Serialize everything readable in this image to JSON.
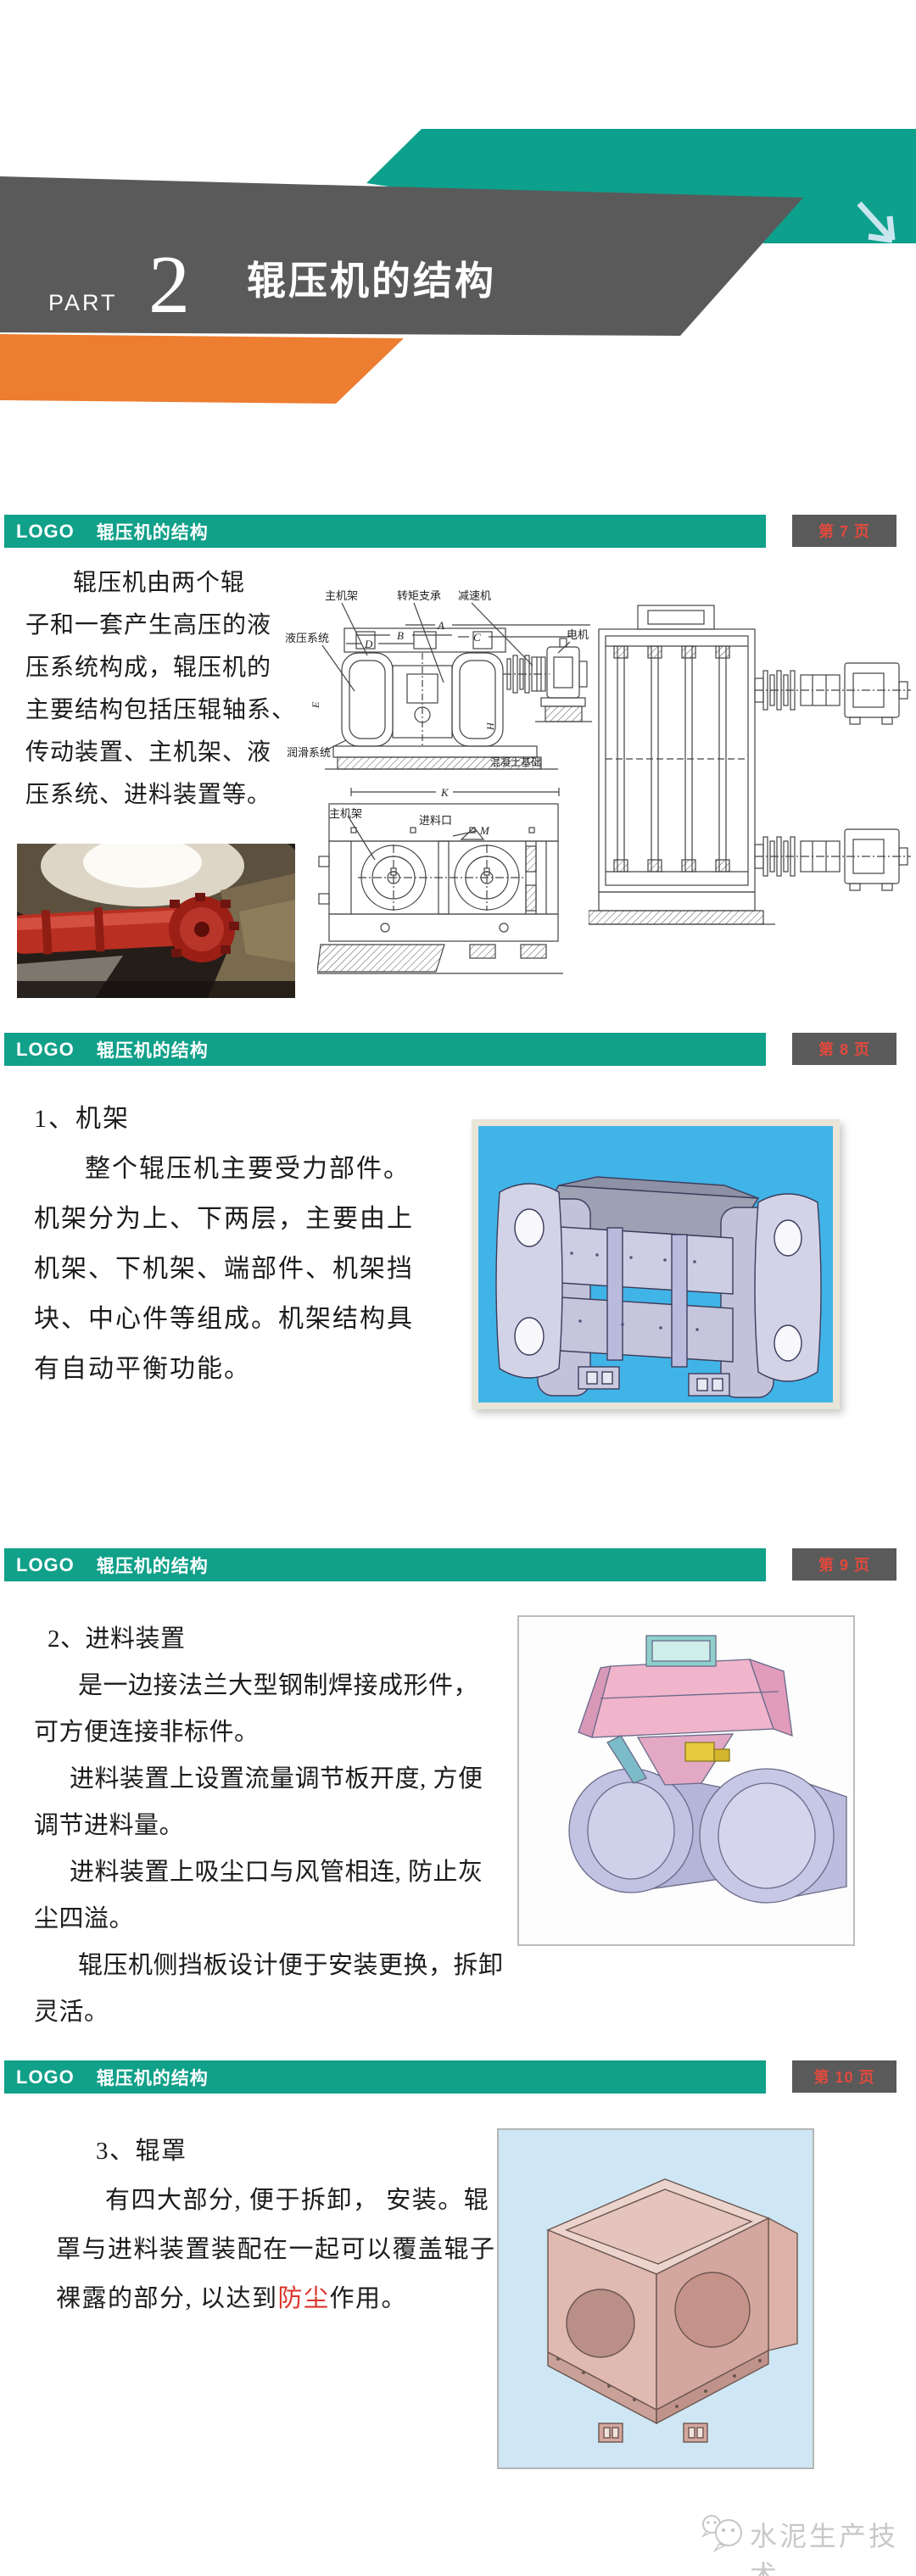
{
  "colors": {
    "teal": "#11A089",
    "dark_gray": "#5A5A5A",
    "orange": "#ED7D31",
    "badge_red": "#E2493D",
    "pic_blue_bg": "#41B4E7",
    "pic_lightblue_bg": "#CFE7F4",
    "watermark_gray": "#C8C8C8"
  },
  "cover": {
    "part_label": "PART",
    "part_number": "2",
    "title": "辊压机的结构",
    "arrow_icon": "arrow-down-right"
  },
  "header": {
    "logo": "LOGO",
    "title": "辊压机的结构"
  },
  "slide7": {
    "page_label": "第 7 页",
    "lines": [
      "辊压机由两个辊",
      "子和一套产生高压的液",
      "压系统构成，辊压机的",
      "主要结构包括压辊轴系、",
      "传动装置、主机架、液",
      "压系统、进料装置等。"
    ],
    "labels": {
      "frame": "主机架",
      "hydraulic": "液压系统",
      "torque": "转矩支承",
      "reducer": "减速机",
      "motor": "电机",
      "lube": "润滑系统",
      "foundation": "混凝土基础",
      "frame2": "主机架",
      "inlet": "进料口",
      "dimA": "A",
      "dimB": "B",
      "dimC": "C",
      "dimD": "D",
      "dimE": "E",
      "dimH": "H",
      "dimK": "K",
      "dimM": "M"
    }
  },
  "slide8": {
    "page_label": "第 8 页",
    "lines": [
      "1、机架",
      "整个辊压机主要受力部件。",
      "机架分为上、下两层，主要由上",
      "机架、下机架、端部件、机架挡",
      "块、中心件等组成。机架结构具",
      "有自动平衡功能。"
    ]
  },
  "slide9": {
    "page_label": "第 9 页",
    "lines": [
      "2、进料装置",
      "是一边接法兰大型钢制焊接成形件，",
      "可方便连接非标件。",
      "进料装置上设置流量调节板开度, 方便",
      "调节进料量。",
      "进料装置上吸尘口与风管相连, 防止灰",
      "尘四溢。",
      "辊压机侧挡板设计便于安装更换，拆卸",
      "灵活。"
    ]
  },
  "slide10": {
    "page_label": "第 10 页",
    "line0": "3、辊罩",
    "line1": "有四大部分, 便于拆卸， 安装。辊",
    "line2": "罩与进料装置装配在一起可以覆盖辊子",
    "line3_pre": "裸露的部分, 以达到",
    "line3_red": "防尘",
    "line3_post": "作用。"
  },
  "footer": {
    "brand": "水泥生产技术"
  }
}
